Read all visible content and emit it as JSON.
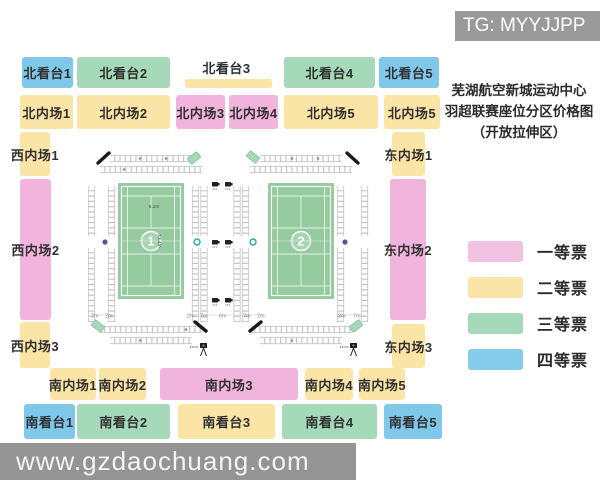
{
  "watermarks": {
    "top": "TG: MYYJJPP",
    "bottom": "www.gzdaochuang.com",
    "bar_color": "#9a9a9a",
    "bottom_bar_color": "#949494"
  },
  "title": {
    "line1": "芜湖航空新城运动中心",
    "line2": "羽超联赛座位分区价格图",
    "line3": "（开放拉伸区）"
  },
  "legend": {
    "items": [
      {
        "label": "一等票",
        "color": "#F2C2E3"
      },
      {
        "label": "二等票",
        "color": "#FBE5A6"
      },
      {
        "label": "三等票",
        "color": "#A6D9BA"
      },
      {
        "label": "四等票",
        "color": "#85CBEA"
      }
    ]
  },
  "tier_colors": {
    "tier1": "#F1B4DD",
    "tier2": "#FBE5A6",
    "tier3": "#A6D9BA",
    "tier4": "#7FC8EA",
    "none": "transparent"
  },
  "zones": [
    {
      "label": "北看台1",
      "tier": "tier4",
      "x": 22,
      "y": 57,
      "w": 51,
      "h": 31
    },
    {
      "label": "北看台2",
      "tier": "tier3",
      "x": 77,
      "y": 57,
      "w": 93,
      "h": 31
    },
    {
      "label": "北看台3",
      "tier": "none",
      "x": 178,
      "y": 55,
      "w": 97,
      "h": 24
    },
    {
      "label": "",
      "tier": "tier2",
      "x": 185,
      "y": 79,
      "w": 87,
      "h": 9
    },
    {
      "label": "北看台4",
      "tier": "tier3",
      "x": 284,
      "y": 57,
      "w": 91,
      "h": 31
    },
    {
      "label": "北看台5",
      "tier": "tier4",
      "x": 379,
      "y": 57,
      "w": 60,
      "h": 31
    },
    {
      "label": "北内场1",
      "tier": "tier2",
      "x": 20,
      "y": 95,
      "w": 53,
      "h": 34
    },
    {
      "label": "北内场2",
      "tier": "tier2",
      "x": 77,
      "y": 95,
      "w": 93,
      "h": 34
    },
    {
      "label": "北内场3",
      "tier": "tier1",
      "x": 176,
      "y": 95,
      "w": 49,
      "h": 34
    },
    {
      "label": "北内场4",
      "tier": "tier1",
      "x": 229,
      "y": 95,
      "w": 49,
      "h": 34
    },
    {
      "label": "北内场5",
      "tier": "tier2",
      "x": 284,
      "y": 95,
      "w": 94,
      "h": 34
    },
    {
      "label": "北内场5",
      "tier": "tier2",
      "x": 384,
      "y": 95,
      "w": 56,
      "h": 34
    },
    {
      "label": "西内场1",
      "tier": "tier2",
      "x": 20,
      "y": 132,
      "w": 30,
      "h": 44
    },
    {
      "label": "西内场2",
      "tier": "tier1",
      "x": 20,
      "y": 179,
      "w": 31,
      "h": 141
    },
    {
      "label": "西内场3",
      "tier": "tier2",
      "x": 20,
      "y": 322,
      "w": 30,
      "h": 46
    },
    {
      "label": "东内场1",
      "tier": "tier2",
      "x": 392,
      "y": 132,
      "w": 33,
      "h": 44
    },
    {
      "label": "东内场2",
      "tier": "tier1",
      "x": 390,
      "y": 179,
      "w": 36,
      "h": 141
    },
    {
      "label": "东内场3",
      "tier": "tier2",
      "x": 392,
      "y": 324,
      "w": 33,
      "h": 44
    },
    {
      "label": "南内场1",
      "tier": "tier2",
      "x": 50,
      "y": 368,
      "w": 46,
      "h": 32
    },
    {
      "label": "南内场2",
      "tier": "tier2",
      "x": 99,
      "y": 368,
      "w": 47,
      "h": 32
    },
    {
      "label": "南内场3",
      "tier": "tier1",
      "x": 160,
      "y": 368,
      "w": 138,
      "h": 32
    },
    {
      "label": "南内场4",
      "tier": "tier2",
      "x": 305,
      "y": 368,
      "w": 48,
      "h": 32
    },
    {
      "label": "南内场5",
      "tier": "tier2",
      "x": 359,
      "y": 368,
      "w": 46,
      "h": 32
    },
    {
      "label": "南看台1",
      "tier": "tier4",
      "x": 24,
      "y": 404,
      "w": 51,
      "h": 35
    },
    {
      "label": "南看台2",
      "tier": "tier3",
      "x": 77,
      "y": 404,
      "w": 93,
      "h": 35
    },
    {
      "label": "南看台3",
      "tier": "tier2",
      "x": 178,
      "y": 404,
      "w": 97,
      "h": 35
    },
    {
      "label": "南看台4",
      "tier": "tier3",
      "x": 282,
      "y": 404,
      "w": 95,
      "h": 35
    },
    {
      "label": "南看台5",
      "tier": "tier4",
      "x": 384,
      "y": 404,
      "w": 58,
      "h": 35
    }
  ],
  "arena": {
    "court_color": "#96CBA0",
    "court_line_color": "#ffffff",
    "strip_color": "#c4c4c4",
    "courts": [
      {
        "number": "1",
        "x": 30,
        "show_dims": true
      },
      {
        "number": "2",
        "x": 180,
        "show_dims": false
      }
    ],
    "court_dims": {
      "width": "6.1m",
      "length": "13.4m"
    },
    "floor_labels": [
      {
        "x": 3,
        "text": "7m"
      },
      {
        "x": 17,
        "text": "2m"
      },
      {
        "x": 99,
        "text": "2m"
      },
      {
        "x": 112,
        "text": "7m"
      },
      {
        "x": 131,
        "text": "6m"
      },
      {
        "x": 155,
        "text": "7m"
      },
      {
        "x": 169,
        "text": "2m"
      },
      {
        "x": 250,
        "text": "2m"
      },
      {
        "x": 265,
        "text": "7m"
      }
    ],
    "strips_h": [
      {
        "x1": 22,
        "x2": 104,
        "y": 8.5
      },
      {
        "x1": 12,
        "x2": 114,
        "y": 19.5
      },
      {
        "x1": 12,
        "x2": 114,
        "y": 179.5
      },
      {
        "x1": 22,
        "x2": 104,
        "y": 190.5
      },
      {
        "x1": 172,
        "x2": 254,
        "y": 8.5
      },
      {
        "x1": 162,
        "x2": 264,
        "y": 19.5
      },
      {
        "x1": 162,
        "x2": 264,
        "y": 179.5
      },
      {
        "x1": 172,
        "x2": 254,
        "y": 190.5
      }
    ],
    "strips_v_x": [
      3.5,
      23.5,
      107.5,
      116,
      149,
      157.5,
      252.5,
      276.5
    ],
    "strips_v_segments": [
      [
        36,
        86
      ],
      [
        98,
        172
      ]
    ],
    "red_dots": [
      [
        52,
        8.5
      ],
      [
        78,
        8.5
      ],
      [
        204,
        8.5
      ],
      [
        230,
        8.5
      ],
      [
        36,
        19.5
      ],
      [
        98,
        179.5
      ],
      [
        52,
        190.5
      ],
      [
        204,
        190.5
      ]
    ],
    "dots": [
      {
        "x": 17,
        "y": 92,
        "kind": "purple"
      },
      {
        "x": 109,
        "y": 92,
        "kind": "teal"
      },
      {
        "x": 165,
        "y": 92,
        "kind": "teal"
      },
      {
        "x": 257,
        "y": 92,
        "kind": "purple"
      }
    ],
    "dot_colors": {
      "purple": "#5e4fa2",
      "teal": "#2fa9a0"
    }
  }
}
